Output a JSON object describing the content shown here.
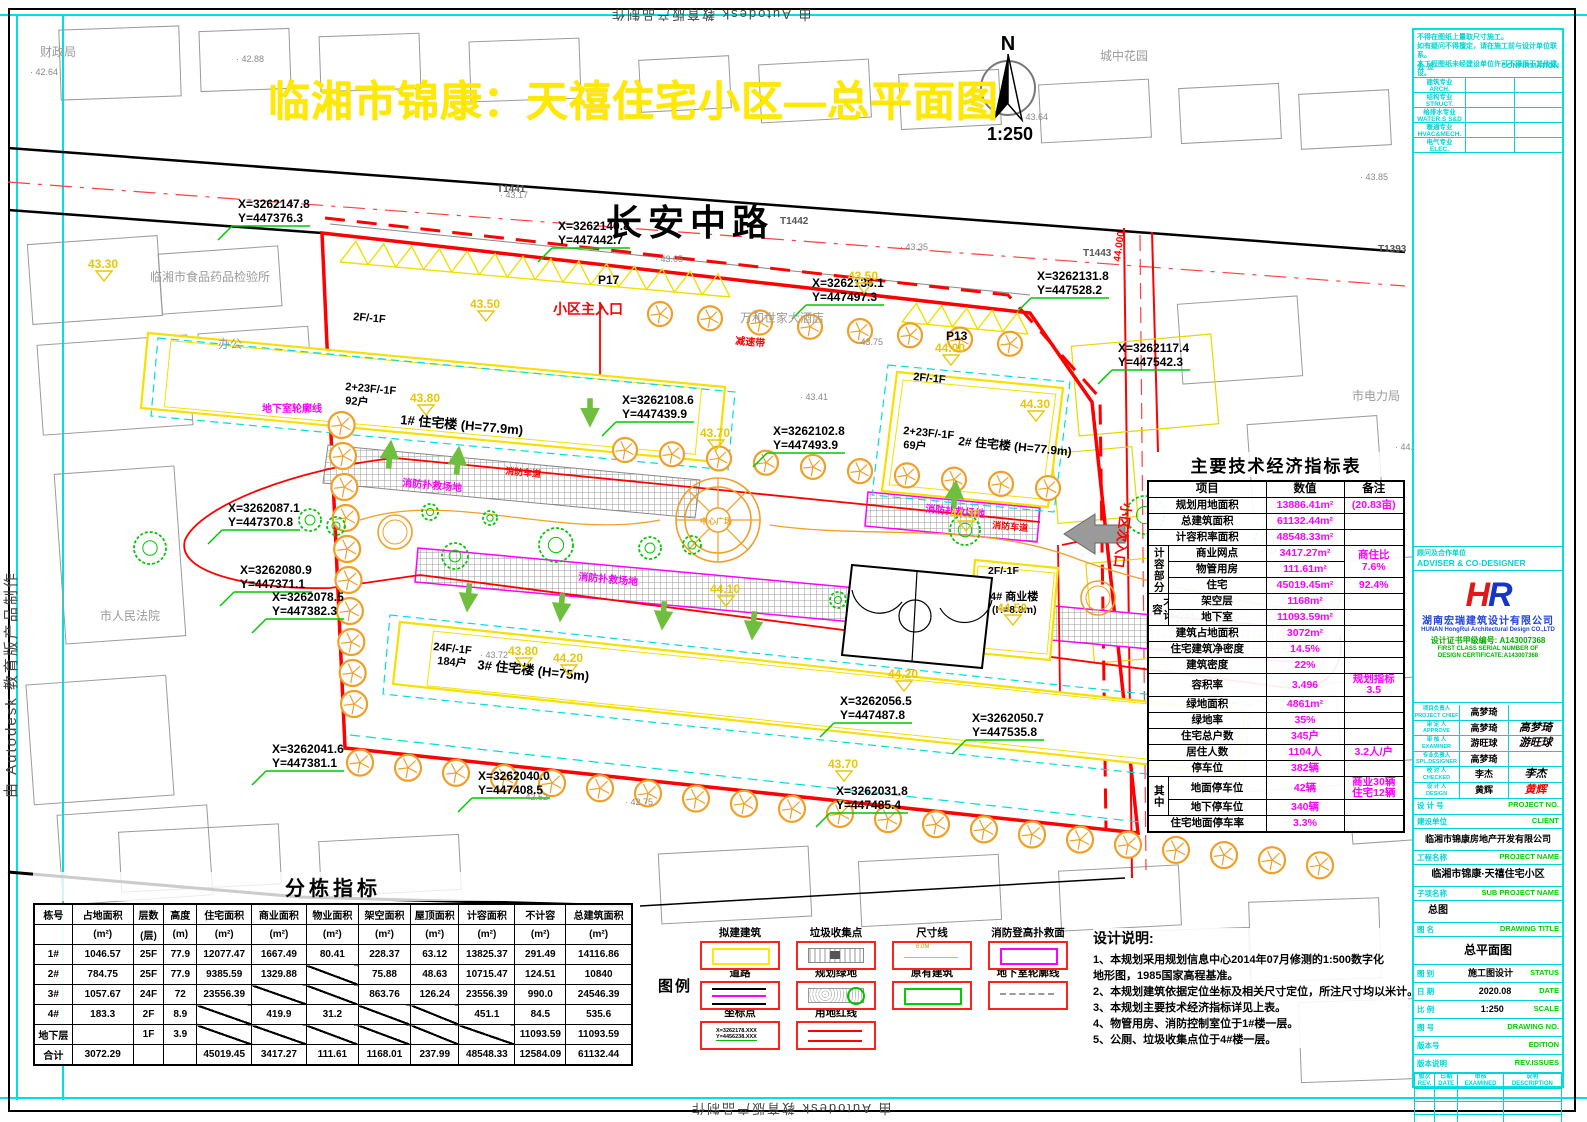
{
  "page": {
    "autodesk_credit": "由 Autodesk 教育版产品制作"
  },
  "title": {
    "text": "临湘市锦康：天禧住宅小区—总平面图",
    "color": "#ffe900"
  },
  "map": {
    "street_name": "长安中路",
    "north": {
      "letter": "N",
      "scale": "1:250"
    },
    "entrances": {
      "main": "小区主入口",
      "secondary": "小区次入口",
      "speed_bump": "减速带"
    },
    "buildings": [
      {
        "podium": "2F/-1F",
        "floors": "2+23F/-1F",
        "units": "92户",
        "name": "1# 住宅楼 (H=77.9m)"
      },
      {
        "podium": "2F/-1F",
        "floors": "2+23F/-1F",
        "units": "69户",
        "name": "2# 住宅楼 (H=77.9m)"
      },
      {
        "floors": "24F/-1F",
        "units": "184户",
        "name": "3# 住宅楼 (H=75m)"
      },
      {
        "podium": "2F/-1F",
        "name": "4# 商业楼",
        "name2": "(H=8.9m)"
      }
    ],
    "parking": [
      "P17",
      "P13"
    ],
    "fire_pad_label": "消防扑救场地",
    "fire_lane_label": "消防车道",
    "plaza_label": "中心广场",
    "basement_label": "地下室轮廓线",
    "road_marks": [
      "T1441",
      "T1442",
      "T1443",
      "T1393"
    ],
    "road_elev": "44.000",
    "surroundings": [
      "财政局",
      "临湘市食品药品检验所",
      "办公",
      "市人民法院",
      "万和世家大酒店",
      "城中花园",
      "市电力局"
    ],
    "coordinates": [
      {
        "x": "X=3262147.8",
        "y": "Y=447376.3"
      },
      {
        "x": "X=3262140.8",
        "y": "Y=447442.7"
      },
      {
        "x": "X=3262136.1",
        "y": "Y=447497.3"
      },
      {
        "x": "X=3262131.8",
        "y": "Y=447528.2"
      },
      {
        "x": "X=3262117.4",
        "y": "Y=447542.3"
      },
      {
        "x": "X=3262108.6",
        "y": "Y=447439.9"
      },
      {
        "x": "X=3262102.8",
        "y": "Y=447493.9"
      },
      {
        "x": "X=3262087.1",
        "y": "Y=447370.8"
      },
      {
        "x": "X=3262080.9",
        "y": "Y=447371.1"
      },
      {
        "x": "X=3262078.5",
        "y": "Y=447382.3"
      },
      {
        "x": "X=3262056.5",
        "y": "Y=447487.8"
      },
      {
        "x": "X=3262050.7",
        "y": "Y=447535.8"
      },
      {
        "x": "X=3262041.6",
        "y": "Y=447381.1"
      },
      {
        "x": "X=3262040.0",
        "y": "Y=447408.5"
      },
      {
        "x": "X=3262031.8",
        "y": "Y=447485.4"
      }
    ],
    "elev_markers": [
      "43.30",
      "43.50",
      "43.50",
      "43.80",
      "43.80",
      "43.70",
      "43.70",
      "44.00",
      "44.30",
      "44.30",
      "44.20",
      "44.20",
      "44.10",
      "44.50"
    ],
    "spot_elevations": [
      "42.88",
      "42.64",
      "43.17",
      "43.05",
      "43.35",
      "43.64",
      "43.75",
      "43.41",
      "43.72",
      "42.52",
      "42.75",
      "45.13",
      "44.17",
      "43.85",
      "44.29",
      "45.22"
    ]
  },
  "econ_table": {
    "title": "主要技术经济指标表",
    "rows": [
      [
        {
          "t": "项目",
          "c": 2,
          "cls": "h"
        },
        {
          "t": "数值",
          "cls": "h"
        },
        {
          "t": "备注",
          "cls": "h"
        }
      ],
      [
        {
          "t": "规划用地面积",
          "c": 2
        },
        {
          "t": "13886.41m²",
          "cls": "m"
        },
        {
          "t": "(20.83亩)",
          "cls": "m"
        }
      ],
      [
        {
          "t": "总建筑面积",
          "c": 2
        },
        {
          "t": "61132.44m²",
          "cls": "m"
        },
        {
          "t": ""
        }
      ],
      [
        {
          "t": "计容积率面积",
          "c": 2
        },
        {
          "t": "48548.33m²",
          "cls": "m"
        },
        {
          "t": ""
        }
      ],
      [
        {
          "t": "计容部分",
          "r": 3,
          "cls": "v"
        },
        {
          "t": "商业网点"
        },
        {
          "t": "3417.27m²",
          "cls": "m"
        },
        {
          "t": "商住比\n7.6%",
          "r": 2,
          "cls": "m"
        }
      ],
      [
        {
          "t": "物管用房"
        },
        {
          "t": "111.61m²",
          "cls": "m"
        }
      ],
      [
        {
          "t": "住宅"
        },
        {
          "t": "45019.45m²",
          "cls": "m"
        },
        {
          "t": "92.4%",
          "cls": "m"
        }
      ],
      [
        {
          "t": "不计容",
          "r": 2,
          "cls": "v"
        },
        {
          "t": "架空层"
        },
        {
          "t": "1168m²",
          "cls": "m"
        },
        {
          "t": ""
        }
      ],
      [
        {
          "t": "地下室"
        },
        {
          "t": "11093.59m²",
          "cls": "m"
        },
        {
          "t": ""
        }
      ],
      [
        {
          "t": "建筑占地面积",
          "c": 2
        },
        {
          "t": "3072m²",
          "cls": "m"
        },
        {
          "t": ""
        }
      ],
      [
        {
          "t": "住宅建筑净密度",
          "c": 2
        },
        {
          "t": "14.5%",
          "cls": "m"
        },
        {
          "t": ""
        }
      ],
      [
        {
          "t": "建筑密度",
          "c": 2
        },
        {
          "t": "22%",
          "cls": "m"
        },
        {
          "t": ""
        }
      ],
      [
        {
          "t": "容积率",
          "c": 2
        },
        {
          "t": "3.496",
          "cls": "m"
        },
        {
          "t": "规划指标3.5",
          "cls": "m"
        }
      ],
      [
        {
          "t": "绿地面积",
          "c": 2
        },
        {
          "t": "4861m²",
          "cls": "m"
        },
        {
          "t": ""
        }
      ],
      [
        {
          "t": "绿地率",
          "c": 2
        },
        {
          "t": "35%",
          "cls": "m"
        },
        {
          "t": ""
        }
      ],
      [
        {
          "t": "住宅总户数",
          "c": 2
        },
        {
          "t": "345户",
          "cls": "m"
        },
        {
          "t": ""
        }
      ],
      [
        {
          "t": "居住人数",
          "c": 2
        },
        {
          "t": "1104人",
          "cls": "m"
        },
        {
          "t": "3.2人/户",
          "cls": "m"
        }
      ],
      [
        {
          "t": "停车位",
          "c": 2
        },
        {
          "t": "382辆",
          "cls": "m"
        },
        {
          "t": ""
        }
      ],
      [
        {
          "t": "其中",
          "r": 2,
          "cls": "v"
        },
        {
          "t": "地面停车位"
        },
        {
          "t": "42辆",
          "cls": "m"
        },
        {
          "t": "商业30辆\n住宅12辆",
          "cls": "m"
        }
      ],
      [
        {
          "t": "地下停车位"
        },
        {
          "t": "340辆",
          "cls": "m"
        },
        {
          "t": ""
        }
      ],
      [
        {
          "t": "住宅地面停车率",
          "c": 2
        },
        {
          "t": "3.3%",
          "cls": "m"
        },
        {
          "t": ""
        }
      ]
    ]
  },
  "building_table": {
    "title": "分栋指标",
    "headers": [
      "栋号",
      "占地面积",
      "层数",
      "高度",
      "住宅面积",
      "商业面积",
      "物业面积",
      "架空面积",
      "屋顶面积",
      "计容面积",
      "不计容",
      "总建筑面积"
    ],
    "units": [
      "",
      "(m²)",
      "(层)",
      "(m)",
      "(m²)",
      "(m²)",
      "(m²)",
      "(m²)",
      "(m²)",
      "(m²)",
      "(m²)",
      "(m²)"
    ],
    "rows": [
      [
        "1#",
        "1046.57",
        "25F",
        "77.9",
        "12077.47",
        "1667.49",
        "80.41",
        "228.37",
        "63.12",
        "13825.37",
        "291.49",
        "14116.86"
      ],
      [
        "2#",
        "784.75",
        "25F",
        "77.9",
        "9385.59",
        "1329.88",
        "/",
        "75.88",
        "48.63",
        "10715.47",
        "124.51",
        "10840"
      ],
      [
        "3#",
        "1057.67",
        "24F",
        "72",
        "23556.39",
        "/",
        "/",
        "863.76",
        "126.24",
        "23556.39",
        "990.0",
        "24546.39"
      ],
      [
        "4#",
        "183.3",
        "2F",
        "8.9",
        "/",
        "419.9",
        "31.2",
        "/",
        "/",
        "451.1",
        "84.5",
        "535.6"
      ],
      [
        "地下层",
        "",
        "1F",
        "3.9",
        "/",
        "/",
        "/",
        "/",
        "/",
        "/",
        "11093.59",
        "11093.59"
      ],
      [
        "合计",
        "3072.29",
        "",
        "",
        "45019.45",
        "3417.27",
        "111.61",
        "1168.01",
        "237.99",
        "48548.33",
        "12584.09",
        "61132.44"
      ]
    ]
  },
  "legend": {
    "caption": "图例",
    "items": [
      {
        "label": "拟建建筑",
        "type": "proposed"
      },
      {
        "label": "垃圾收集点",
        "type": "garbage"
      },
      {
        "label": "尺寸线",
        "type": "dim",
        "note": "6.0M"
      },
      {
        "label": "消防登高扑救面",
        "type": "fireface"
      },
      {
        "label": "道路",
        "type": "road"
      },
      {
        "label": "规划绿地",
        "type": "green"
      },
      {
        "label": "原有建筑",
        "type": "existing"
      },
      {
        "label": "地下室轮廓线",
        "type": "basement"
      },
      {
        "label": "坐标点",
        "type": "coord",
        "note": "X=3262178.XXX\nY=4456238.XXX"
      },
      {
        "label": "用地红线",
        "type": "redline"
      }
    ]
  },
  "notes": {
    "title": "设计说明:",
    "lines": [
      "1、本规划采用规划信息中心2014年07月修测的1:500数字化",
      "      地形图，1985国家高程基准。",
      "2、本规划建筑依据定位坐标及相关尺寸定位，所注尺寸均以米计。",
      "3、本规划主要技术经济指标详见上表。",
      "4、物管用房、消防控制室位于1#楼一层。",
      "5、公厕、垃圾收集点位于4#楼一层。"
    ]
  },
  "titleblock": {
    "notes": [
      "不得在图纸上量取尺寸施工。",
      "如有疑问不得擅定，请在施工前与设计单位联系。",
      "本工程图纸未经建设单位许可不得用于其他建设。"
    ],
    "confirmation": {
      "zh": "会  签",
      "en": "CONFIRMATION"
    },
    "disciplines": [
      {
        "zh": "建筑专业",
        "en": "ARCH."
      },
      {
        "zh": "结构专业",
        "en": "STRUCT."
      },
      {
        "zh": "给排水专业",
        "en": "WATER.S S&D"
      },
      {
        "zh": "暖通专业",
        "en": "HVAC&MECH."
      },
      {
        "zh": "电气专业",
        "en": "ELEC."
      }
    ],
    "adviser": {
      "zh": "顾问及合作单位",
      "en": "ADVISER & CO-DESIGNER"
    },
    "company": {
      "logo": "HR",
      "name": "湖南宏瑞建筑设计有限公司",
      "name_en": "HUNAN HongRui Architectural Design CO.,LTD",
      "cert": "设计证书甲级编号: A143007368",
      "cert_en1": "FIRST CLASS SERIAL NUMBER OF",
      "cert_en2": "DESIGN CERTIFICATE:A143007368"
    },
    "signatories": [
      {
        "zh": "项目负责人",
        "en": "PROJECT CHIEF",
        "name": "高梦琦",
        "sig": ""
      },
      {
        "zh": "审 定 人",
        "en": "APPROVE",
        "name": "高梦琦",
        "sig": "高梦琦"
      },
      {
        "zh": "审 核 人",
        "en": "EXAMINER",
        "name": "游旺球",
        "sig": "游旺球"
      },
      {
        "zh": "专业负责人",
        "en": "SPL.DESIGNER",
        "name": "高梦琦",
        "sig": ""
      },
      {
        "zh": "校 对 人",
        "en": "CHECKED",
        "name": "李杰",
        "sig": "李杰"
      },
      {
        "zh": "设 计 人",
        "en": "DESIGN",
        "name": "黄辉",
        "sig": "黄辉",
        "sig_color": "#ff0000"
      }
    ],
    "project_no": {
      "zh": "设 计 号",
      "en": "PROJECT NO."
    },
    "client": {
      "zh": "建设单位",
      "en": "CLIENT",
      "value": "临湘市锦康房地产开发有限公司"
    },
    "project_name": {
      "zh": "工程名称",
      "en": "PROJECT NAME",
      "value": "临湘市锦康·天禧住宅小区"
    },
    "sub_project": {
      "zh": "子项名称",
      "en": "SUB PROJECT NAME",
      "value": "总图"
    },
    "drawing_title": {
      "zh": "图  名",
      "en": "DRAWING TITLE",
      "value": "总平面图"
    },
    "status": {
      "zh": "图  别",
      "en": "STATUS",
      "value": "施工图设计"
    },
    "date": {
      "zh": "日  期",
      "en": "DATE",
      "value": "2020.08"
    },
    "scale": {
      "zh": "比  例",
      "en": "SCALE",
      "value": "1:250"
    },
    "drawing_no": {
      "zh": "图  号",
      "en": "DRAWING NO."
    },
    "edition": {
      "zh": "版本号",
      "en": "EDITION"
    },
    "rev_issues": {
      "zh": "版本说明",
      "en": "REV.ISSUES"
    },
    "rev_table": {
      "headers": [
        {
          "zh": "版次",
          "en": "REV."
        },
        {
          "zh": "日期",
          "en": "DATE"
        },
        {
          "zh": "审核",
          "en": "EXAMINED"
        },
        {
          "zh": "说明",
          "en": "DESCRIPTION"
        }
      ],
      "empty_rows": 3
    }
  }
}
